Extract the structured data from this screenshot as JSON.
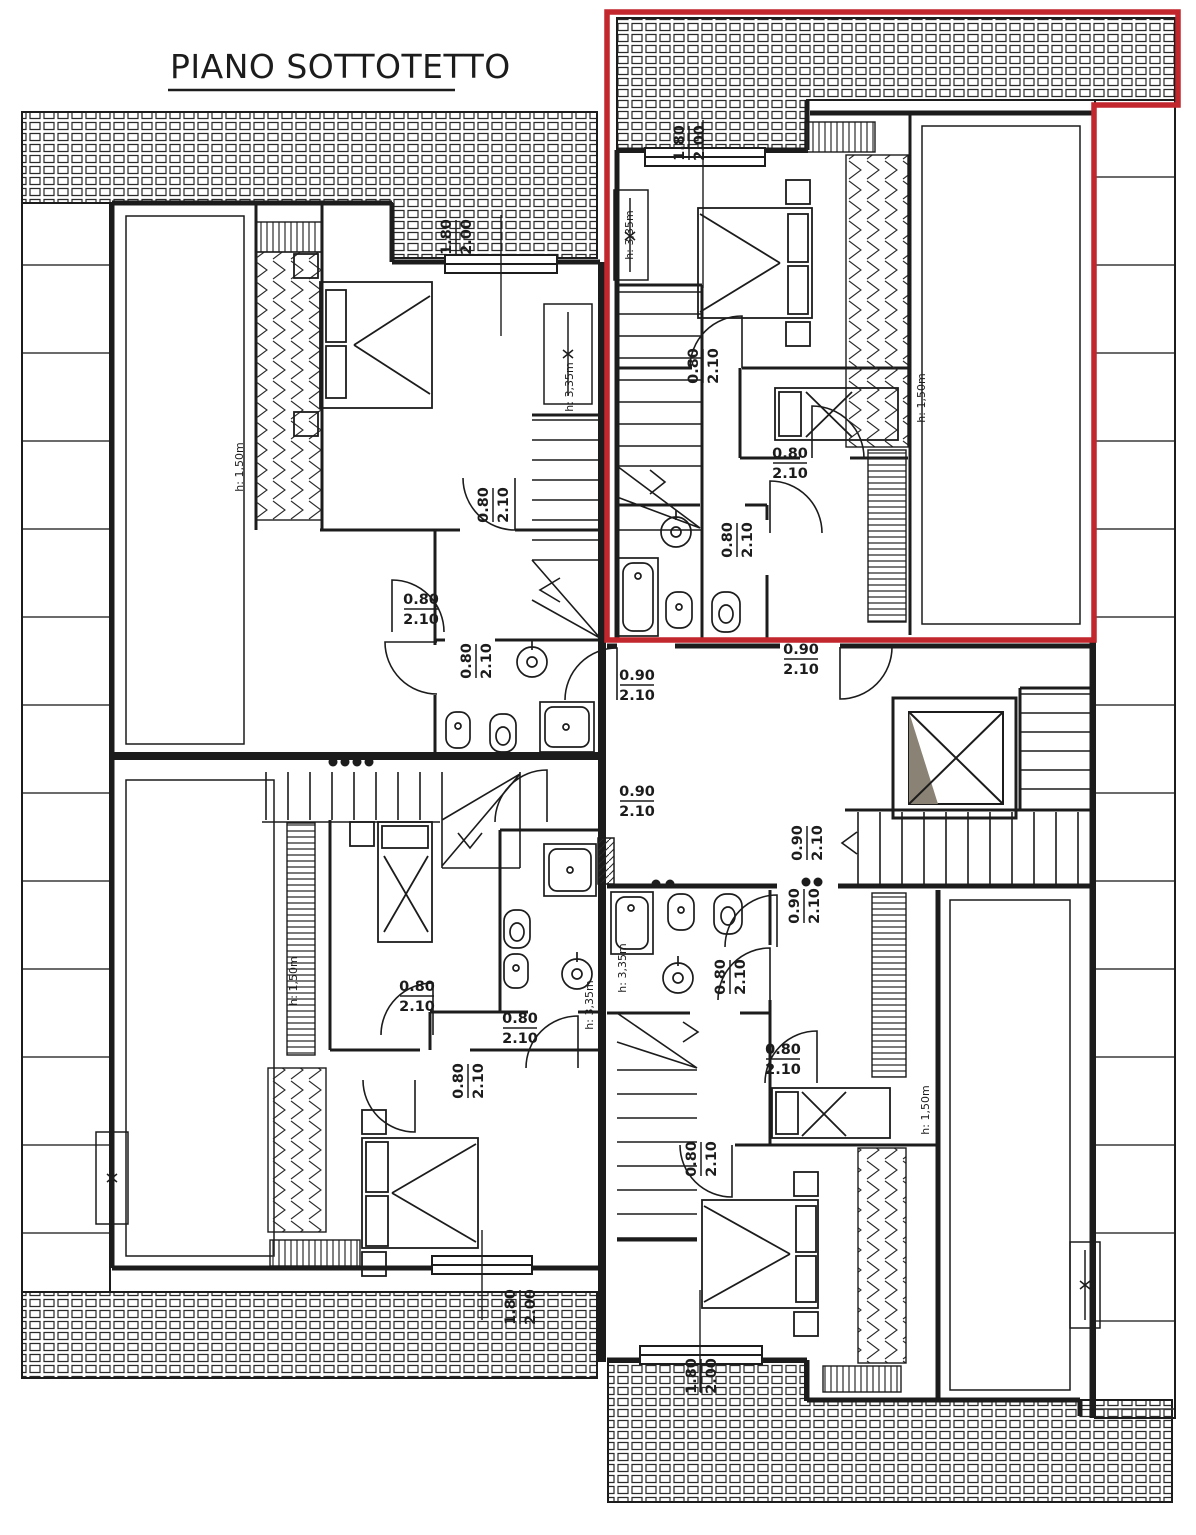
{
  "title": {
    "text": "PIANO SOTTOTETTO"
  },
  "colors": {
    "ink": "#1c1c1c",
    "highlight": "#c1272d",
    "paper": "#ffffff",
    "shade": "#8a8274"
  },
  "dim_labels": [
    {
      "top": "1.80",
      "bottom": "2.00",
      "x": 455,
      "y": 237,
      "rot": -90
    },
    {
      "top": "1.80",
      "bottom": "2.00",
      "x": 688,
      "y": 143,
      "rot": -90
    },
    {
      "top": "1.80",
      "bottom": "2.00",
      "x": 519,
      "y": 1307,
      "rot": -90
    },
    {
      "top": "1.80",
      "bottom": "2.00",
      "x": 700,
      "y": 1376,
      "rot": -90
    },
    {
      "top": "0.80",
      "bottom": "2.10",
      "x": 702,
      "y": 366,
      "rot": -90
    },
    {
      "top": "0.80",
      "bottom": "2.10",
      "x": 790,
      "y": 462,
      "rot": 0
    },
    {
      "top": "0.80",
      "bottom": "2.10",
      "x": 736,
      "y": 540,
      "rot": -90
    },
    {
      "top": "0.90",
      "bottom": "2.10",
      "x": 801,
      "y": 658,
      "rot": 0
    },
    {
      "top": "0.90",
      "bottom": "2.10",
      "x": 637,
      "y": 684,
      "rot": 0
    },
    {
      "top": "0.90",
      "bottom": "2.10",
      "x": 637,
      "y": 800,
      "rot": 0
    },
    {
      "top": "0.90",
      "bottom": "2.10",
      "x": 806,
      "y": 843,
      "rot": -90
    },
    {
      "top": "0.90",
      "bottom": "2.10",
      "x": 803,
      "y": 906,
      "rot": -90
    },
    {
      "top": "0.80",
      "bottom": "2.10",
      "x": 492,
      "y": 505,
      "rot": -90
    },
    {
      "top": "0.80",
      "bottom": "2.10",
      "x": 421,
      "y": 608,
      "rot": 0
    },
    {
      "top": "0.80",
      "bottom": "2.10",
      "x": 475,
      "y": 661,
      "rot": -90
    },
    {
      "top": "0.80",
      "bottom": "2.10",
      "x": 417,
      "y": 995,
      "rot": 0
    },
    {
      "top": "0.80",
      "bottom": "2.10",
      "x": 520,
      "y": 1027,
      "rot": 0
    },
    {
      "top": "0.80",
      "bottom": "2.10",
      "x": 467,
      "y": 1081,
      "rot": -90
    },
    {
      "top": "0.80",
      "bottom": "2.10",
      "x": 729,
      "y": 977,
      "rot": -90
    },
    {
      "top": "0.80",
      "bottom": "2.10",
      "x": 783,
      "y": 1058,
      "rot": 0
    },
    {
      "top": "0.80",
      "bottom": "2.10",
      "x": 700,
      "y": 1159,
      "rot": -90
    }
  ],
  "height_labels": [
    {
      "text": "h: 1,50m",
      "x": 240,
      "y": 467
    },
    {
      "text": "h: 3,35m",
      "x": 570,
      "y": 387
    },
    {
      "text": "h: 3,35m",
      "x": 630,
      "y": 235
    },
    {
      "text": "h: 1,50m",
      "x": 922,
      "y": 398
    },
    {
      "text": "h: 1,50m",
      "x": 294,
      "y": 981
    },
    {
      "text": "h: 3,35m",
      "x": 590,
      "y": 1005
    },
    {
      "text": "h: 3,35m",
      "x": 623,
      "y": 968
    },
    {
      "text": "h: 1,50m",
      "x": 926,
      "y": 1110
    }
  ]
}
